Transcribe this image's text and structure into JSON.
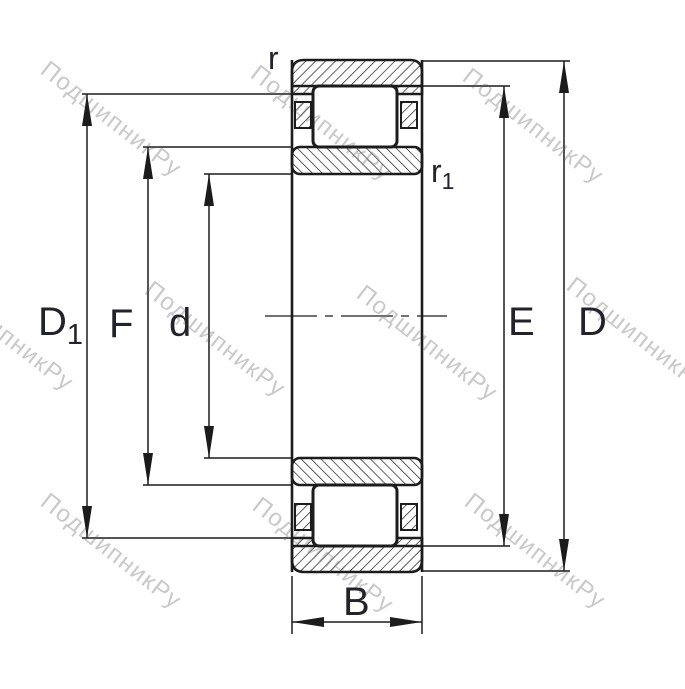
{
  "drawing": {
    "type": "cylindrical-roller-bearing-cross-section",
    "labels": {
      "rib_diameter": {
        "main": "D",
        "sub": "1"
      },
      "inner_raceway_diameter": "F",
      "bore_diameter": "d",
      "outer_raceway_diameter": "E",
      "outer_diameter": "D",
      "width": "B",
      "chamfer": "r",
      "chamfer_inner": {
        "main": "r",
        "sub": "1"
      }
    },
    "watermark": "ПодшипникРу",
    "colors": {
      "line": "#1c1c1c",
      "text": "#23232b",
      "watermark": "#c9c9c9",
      "background": "#ffffff"
    }
  }
}
